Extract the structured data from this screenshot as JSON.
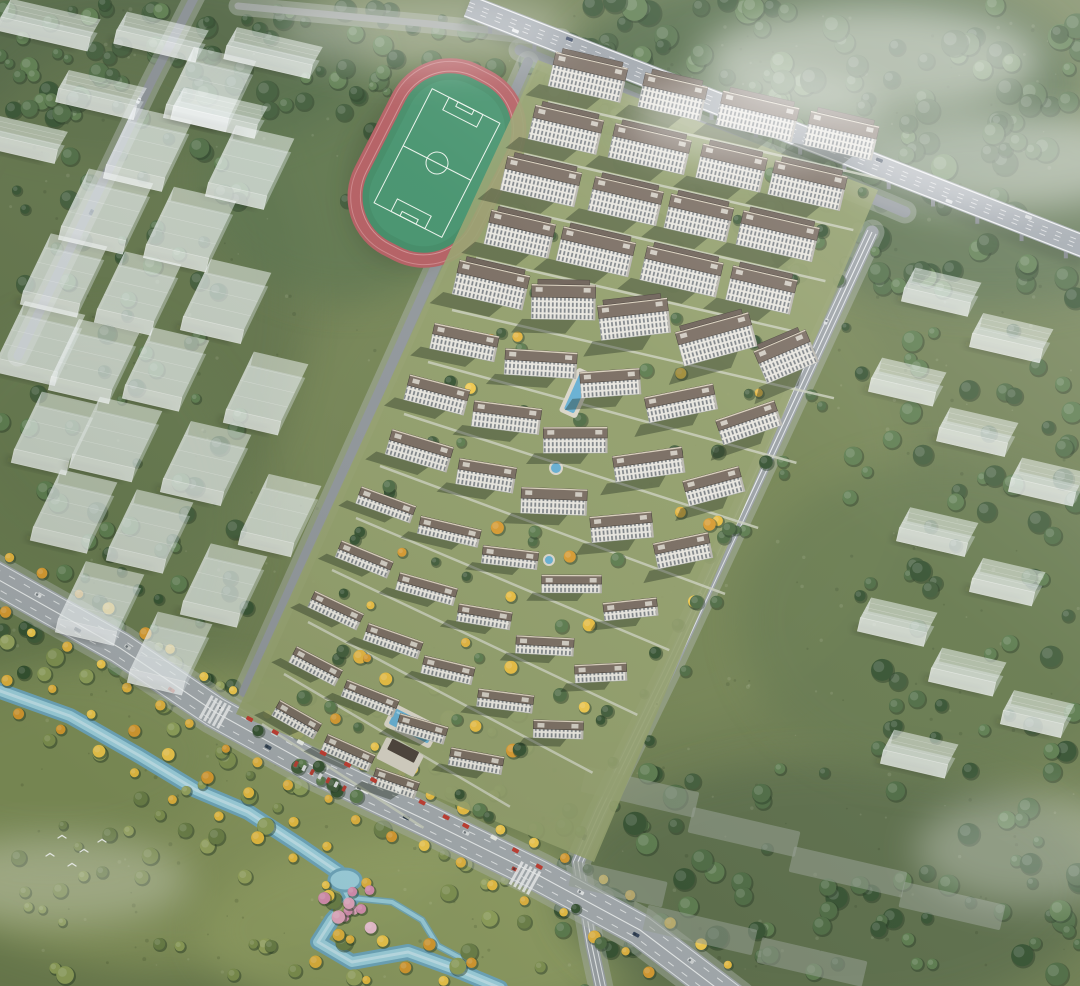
{
  "meta": {
    "kind": "aerial-architectural-rendering",
    "subject": "residential-development-masterplan",
    "width": 1080,
    "height": 986
  },
  "palette": {
    "base_green": "#6d7d50",
    "forest_dark": "#45603d",
    "wetland": "#8c9a60",
    "asphalt_light": "#a3a9ae",
    "asphalt_mid": "#9aa0a5",
    "asphalt_dark": "#8d9399",
    "river_water": "#9fd3e2",
    "pool_water": "#64aed2",
    "track_red": "#b25a5e",
    "pitch_green": "#41906a",
    "pitch_line": "#eaf3eb",
    "facade_light": "#e8e6df",
    "window_dark": "#636b72",
    "roof_brown": "#776a5f",
    "roof_parapet": "#d9cfbc",
    "ghost_white": "rgba(240,244,246,0.42)",
    "tree_yellow": "#e9bd3f",
    "tree_pink": "#e5a7c0",
    "awning_red": "#c0392e",
    "mist_white": "#ffffff"
  },
  "terrain": {
    "base": "#6d7d50",
    "speckles": 520,
    "blobs": [
      [
        140,
        60,
        230,
        95,
        "#4a5f40",
        0.75
      ],
      [
        820,
        85,
        260,
        120,
        "#45603d",
        0.8
      ],
      [
        990,
        210,
        210,
        95,
        "#516a48",
        0.7
      ],
      [
        115,
        300,
        185,
        260,
        "#5d7047",
        0.75
      ],
      [
        85,
        520,
        165,
        205,
        "#65784e",
        0.7
      ],
      [
        600,
        470,
        310,
        270,
        "#7c8b57",
        0.45
      ],
      [
        180,
        820,
        290,
        150,
        "#8c9a60",
        0.85
      ],
      [
        430,
        930,
        230,
        95,
        "#95a366",
        0.8
      ],
      [
        55,
        755,
        170,
        95,
        "#7e8e58",
        0.8
      ],
      [
        830,
        890,
        270,
        130,
        "#576946",
        0.8
      ],
      [
        350,
        180,
        150,
        120,
        "#55704a",
        0.6
      ],
      [
        940,
        620,
        200,
        160,
        "#60744c",
        0.6
      ]
    ]
  },
  "river": {
    "main": [
      [
        -8,
        688
      ],
      [
        70,
        716
      ],
      [
        140,
        756
      ],
      [
        196,
        790
      ],
      [
        248,
        812
      ],
      [
        300,
        846
      ],
      [
        338,
        872
      ],
      [
        352,
        898
      ],
      [
        332,
        920
      ],
      [
        318,
        942
      ],
      [
        352,
        962
      ],
      [
        408,
        952
      ],
      [
        452,
        968
      ],
      [
        500,
        988
      ]
    ],
    "branch": [
      [
        352,
        898
      ],
      [
        392,
        902
      ],
      [
        422,
        920
      ],
      [
        438,
        946
      ],
      [
        472,
        964
      ]
    ],
    "pond": [
      345,
      880,
      16,
      11
    ],
    "colors": [
      "#6fa8bf",
      "#9fd3e2",
      "#c9e9f3"
    ]
  },
  "roads": {
    "boulevard": {
      "pts": [
        [
          -10,
          575
        ],
        [
          120,
          648
        ],
        [
          215,
          712
        ],
        [
          320,
          770
        ],
        [
          430,
          822
        ],
        [
          540,
          876
        ],
        [
          640,
          930
        ],
        [
          735,
          1002
        ]
      ],
      "w": 34,
      "color": "#a3a9ae",
      "cars": [
        [
          0.06,
          -6,
          "#dfe2e4",
          7
        ],
        [
          0.12,
          5,
          "#2f3d4e",
          7
        ],
        [
          0.18,
          -5,
          "#c8cccd",
          7
        ],
        [
          0.25,
          6,
          "#b2392f",
          7
        ],
        [
          0.31,
          -6,
          "#e8eaeb",
          7
        ],
        [
          0.38,
          5,
          "#3a4a5c",
          7
        ],
        [
          0.45,
          -5,
          "#d5d8da",
          7
        ],
        [
          0.5,
          0,
          "#f2f3f4",
          14
        ],
        [
          0.56,
          6,
          "#29384a",
          7
        ],
        [
          0.63,
          -6,
          "#dadddf",
          7
        ],
        [
          0.7,
          5,
          "#b2392f",
          7
        ],
        [
          0.78,
          -5,
          "#e4e6e8",
          7
        ],
        [
          0.86,
          6,
          "#33425a",
          7
        ],
        [
          0.93,
          -6,
          "#d0d4d6",
          7
        ]
      ],
      "crosswalks": [
        [
          215,
          712
        ],
        [
          525,
          878
        ]
      ]
    },
    "east": {
      "pts": [
        [
          872,
          232
        ],
        [
          760,
          474
        ],
        [
          668,
          672
        ],
        [
          600,
          812
        ],
        [
          578,
          862
        ],
        [
          592,
          946
        ],
        [
          604,
          1002
        ]
      ],
      "w": 13,
      "color": "#9aa0a5",
      "cars": [
        [
          0.12,
          4,
          "#dde0e2",
          6
        ],
        [
          0.3,
          -4,
          "#2e3c4e",
          6
        ],
        [
          0.48,
          4,
          "#e6e8ea",
          6
        ],
        [
          0.62,
          -4,
          "#c7cbcd",
          6
        ],
        [
          0.8,
          4,
          "#31405a",
          6
        ]
      ]
    },
    "west": {
      "pts": [
        [
          528,
          62
        ],
        [
          244,
          692
        ]
      ],
      "w": 10,
      "color": "#8f959a",
      "cars": []
    },
    "north": {
      "pts": [
        [
          520,
          50
        ],
        [
          905,
          212
        ]
      ],
      "w": 11,
      "color": "#8d9399",
      "cars": []
    },
    "topleft": {
      "pts": [
        [
          196,
          -6
        ],
        [
          150,
          84
        ],
        [
          96,
          196
        ],
        [
          46,
          298
        ],
        [
          18,
          356
        ]
      ],
      "w": 9,
      "color": "#878d92",
      "cars": [
        [
          0.3,
          3,
          "#e4e6e8",
          6
        ],
        [
          0.6,
          -3,
          "#36445c",
          6
        ]
      ]
    },
    "topedge": {
      "pts": [
        [
          238,
          6
        ],
        [
          430,
          24
        ],
        [
          562,
          38
        ]
      ],
      "w": 7,
      "color": "#9aa09b",
      "cars": []
    }
  },
  "highway": {
    "pts": [
      [
        468,
        6
      ],
      [
        1088,
        248
      ]
    ],
    "w": 24,
    "color": "#9aa1a8",
    "piers": 14,
    "cars": [
      [
        0.08,
        6,
        "#e8eaec",
        7
      ],
      [
        0.16,
        -6,
        "#32405c",
        7
      ],
      [
        0.3,
        7,
        "#d8dbdd",
        7
      ],
      [
        0.42,
        -7,
        "#b2392f",
        7
      ],
      [
        0.55,
        6,
        "#e2e4e6",
        7
      ],
      [
        0.66,
        -6,
        "#2c3a4c",
        7
      ],
      [
        0.78,
        7,
        "#dcdfe1",
        7
      ],
      [
        0.9,
        -7,
        "#cfd3d5",
        7
      ]
    ]
  },
  "stadium": {
    "cx": 437,
    "cy": 163,
    "rot": 27,
    "track": "#b25a5e",
    "lane": "#d08b8e",
    "field": "#41906a",
    "line": "#eaf3eb"
  },
  "ghosts": {
    "left": [
      [
        196,
        118,
        64
      ],
      [
        134,
        178,
        60
      ],
      [
        92,
        240,
        66
      ],
      [
        50,
        304,
        58
      ],
      [
        26,
        372,
        62
      ],
      [
        236,
        196,
        60
      ],
      [
        176,
        258,
        64
      ],
      [
        124,
        322,
        58
      ],
      [
        80,
        390,
        62
      ],
      [
        40,
        462,
        56
      ],
      [
        212,
        330,
        62
      ],
      [
        152,
        398,
        58
      ],
      [
        102,
        468,
        64
      ],
      [
        60,
        540,
        58
      ],
      [
        252,
        422,
        56
      ],
      [
        192,
        492,
        62
      ],
      [
        136,
        560,
        58
      ],
      [
        86,
        632,
        60
      ],
      [
        266,
        544,
        54
      ],
      [
        210,
        614,
        58
      ],
      [
        156,
        682,
        56
      ]
    ],
    "topleft": [
      [
        44,
        34,
        92
      ],
      [
        156,
        46,
        84
      ],
      [
        268,
        62,
        88
      ],
      [
        96,
        104,
        80
      ],
      [
        214,
        122,
        86
      ],
      [
        18,
        148,
        78
      ]
    ],
    "right": [
      [
        936,
        302,
        68
      ],
      [
        1006,
        348,
        72
      ],
      [
        902,
        392,
        66
      ],
      [
        972,
        442,
        70
      ],
      [
        1042,
        492,
        66
      ],
      [
        932,
        542,
        70
      ],
      [
        1002,
        592,
        64
      ],
      [
        892,
        632,
        68
      ],
      [
        962,
        682,
        66
      ],
      [
        1032,
        724,
        62
      ],
      [
        914,
        764,
        66
      ]
    ],
    "flats": [
      [
        640,
        792,
        116
      ],
      [
        744,
        832,
        110
      ],
      [
        848,
        872,
        116
      ],
      [
        952,
        906,
        104
      ],
      [
        700,
        930,
        112
      ],
      [
        812,
        962,
        108
      ],
      [
        618,
        884,
        96
      ]
    ]
  },
  "compound": {
    "ground": "#93a06b",
    "groundPoly": [
      [
        538,
        60
      ],
      [
        878,
        190
      ],
      [
        594,
        862
      ],
      [
        236,
        714
      ]
    ],
    "sizes": {
      "tall": {
        "fh": 22,
        "rd": 13
      },
      "mid": {
        "fh": 15,
        "rd": 11
      },
      "low": {
        "fh": 9,
        "rd": 9
      }
    },
    "roof": "#776a5f",
    "roofEdge": "#d9cfbc",
    "unit": "#cfcac0",
    "facadeStroke": "#9aa0a0",
    "rows": [
      {
        "x": 548,
        "y": 86,
        "s": "tall",
        "b": [
          [
            0,
            74
          ],
          [
            92,
            64
          ],
          [
            172,
            78
          ],
          [
            262,
            70
          ]
        ]
      },
      {
        "x": 524,
        "y": 138,
        "s": "tall",
        "b": [
          [
            4,
            70
          ],
          [
            86,
            78
          ],
          [
            176,
            66
          ],
          [
            250,
            74
          ]
        ]
      },
      {
        "x": 500,
        "y": 190,
        "s": "tall",
        "b": [
          [
            0,
            76
          ],
          [
            90,
            70
          ],
          [
            168,
            64
          ],
          [
            242,
            78
          ]
        ]
      },
      {
        "x": 476,
        "y": 242,
        "s": "tall",
        "b": [
          [
            8,
            66
          ],
          [
            82,
            74
          ],
          [
            168,
            78
          ],
          [
            256,
            66
          ]
        ]
      },
      {
        "x": 452,
        "y": 294,
        "s": "tall",
        "b": [
          [
            0,
            72
          ],
          [
            82,
            64
          ],
          [
            154,
            70
          ],
          [
            238,
            76
          ],
          [
            322,
            56
          ]
        ]
      },
      {
        "x": 428,
        "y": 346,
        "s": "mid",
        "b": [
          [
            2,
            66
          ],
          [
            80,
            72
          ],
          [
            160,
            60
          ],
          [
            230,
            70
          ],
          [
            306,
            62
          ]
        ]
      },
      {
        "x": 404,
        "y": 398,
        "s": "mid",
        "b": [
          [
            0,
            62
          ],
          [
            72,
            68
          ],
          [
            148,
            64
          ],
          [
            224,
            70
          ],
          [
            300,
            58
          ]
        ]
      },
      {
        "x": 380,
        "y": 450,
        "s": "mid",
        "b": [
          [
            6,
            64
          ],
          [
            82,
            58
          ],
          [
            152,
            66
          ],
          [
            228,
            62
          ],
          [
            298,
            56
          ]
        ]
      },
      {
        "x": 356,
        "y": 502,
        "s": "low",
        "b": [
          [
            0,
            58
          ],
          [
            68,
            62
          ],
          [
            138,
            56
          ],
          [
            204,
            60
          ],
          [
            272,
            54
          ]
        ]
      },
      {
        "x": 332,
        "y": 554,
        "s": "low",
        "b": [
          [
            4,
            56
          ],
          [
            72,
            60
          ],
          [
            140,
            54
          ],
          [
            206,
            58
          ],
          [
            272,
            52
          ]
        ]
      },
      {
        "x": 308,
        "y": 606,
        "s": "low",
        "b": [
          [
            0,
            54
          ],
          [
            64,
            58
          ],
          [
            130,
            52
          ],
          [
            194,
            56
          ],
          [
            258,
            50
          ]
        ]
      },
      {
        "x": 284,
        "y": 658,
        "s": "low",
        "b": [
          [
            6,
            52
          ],
          [
            68,
            56
          ],
          [
            132,
            50
          ],
          [
            194,
            54
          ]
        ]
      },
      {
        "x": 262,
        "y": 708,
        "s": "low",
        "b": [
          [
            12,
            48
          ],
          [
            72,
            52
          ],
          [
            132,
            46
          ]
        ]
      }
    ],
    "pools": [
      [
        577,
        393,
        11,
        40,
        24
      ],
      [
        412,
        726,
        44,
        17,
        27
      ]
    ],
    "ponds": [
      [
        556,
        468,
        6
      ],
      [
        549,
        560,
        5
      ]
    ],
    "entrance": {
      "plaza": [
        400,
        757,
        42,
        24,
        27,
        "#d6d1c4"
      ],
      "canopy": [
        398,
        748,
        30,
        12,
        "#4a4038"
      ]
    },
    "awnings": {
      "a": [
        252,
        718
      ],
      "b": [
        540,
        864
      ],
      "n": 13,
      "red": "#c0392e",
      "white": "#eceee9"
    },
    "parked": {
      "x": 296,
      "y": 764,
      "ang": 27,
      "n": 7,
      "colors": [
        "#b83a30",
        "#dddfe0"
      ]
    },
    "rowTrees": {
      "n": 9,
      "offset": 30
    }
  },
  "trees": {
    "palettes": {
      "green": [
        "#3f5a38",
        "#4c6a42",
        "#5a7a4c",
        "#33502f"
      ],
      "lime": [
        "#7f9150",
        "#8fa05a",
        "#6c8048",
        "#97a55f"
      ],
      "yellow": [
        "#e3b33c",
        "#f0c84a",
        "#d89a2e",
        "#e9bd3f"
      ],
      "pink": [
        "#e5a7c0",
        "#d98fb2",
        "#efc2d4"
      ]
    },
    "regions": [
      {
        "x": 0,
        "y": 50,
        "w": 250,
        "h": 640,
        "n": 110,
        "pal": "green",
        "rmin": 4,
        "rmax": 10
      },
      {
        "x": 0,
        "y": 0,
        "w": 620,
        "h": 115,
        "n": 85,
        "pal": "green",
        "rmin": 4,
        "rmax": 11
      },
      {
        "x": 600,
        "y": 0,
        "w": 480,
        "h": 290,
        "n": 130,
        "pal": "green",
        "rmin": 6,
        "rmax": 13
      },
      {
        "x": 845,
        "y": 250,
        "w": 235,
        "h": 520,
        "n": 70,
        "pal": "green",
        "rmin": 5,
        "rmax": 11
      },
      {
        "x": 555,
        "y": 760,
        "w": 525,
        "h": 220,
        "n": 80,
        "pal": "green",
        "rmin": 5,
        "rmax": 12
      },
      {
        "x": 0,
        "y": 640,
        "w": 555,
        "h": 340,
        "n": 95,
        "pal": "lime",
        "rmin": 4,
        "rmax": 9
      },
      {
        "x": 330,
        "y": 50,
        "w": 200,
        "h": 215,
        "n": 26,
        "pal": "green",
        "rmin": 4,
        "rmax": 9
      }
    ],
    "lines": {
      "boulevard": {
        "n": 46,
        "off": 26,
        "pal": "yellow"
      },
      "river": {
        "n": 30,
        "off": 16,
        "pal": "yellow"
      },
      "east": {
        "n": 22,
        "off": 12,
        "pal": "green"
      }
    }
  },
  "pinkGrove": {
    "cx": 347,
    "cy": 906,
    "n": 10
  },
  "birds": [
    [
      62,
      838
    ],
    [
      84,
      852
    ],
    [
      72,
      866
    ],
    [
      102,
      842
    ],
    [
      50,
      856
    ]
  ],
  "mist": [
    [
      870,
      60,
      170,
      55,
      0.5
    ],
    [
      1000,
      160,
      150,
      50,
      0.45
    ],
    [
      760,
      120,
      130,
      45,
      0.4
    ],
    [
      420,
      30,
      150,
      40,
      0.3
    ],
    [
      60,
      880,
      130,
      45,
      0.3
    ],
    [
      1030,
      850,
      115,
      55,
      0.3
    ]
  ]
}
